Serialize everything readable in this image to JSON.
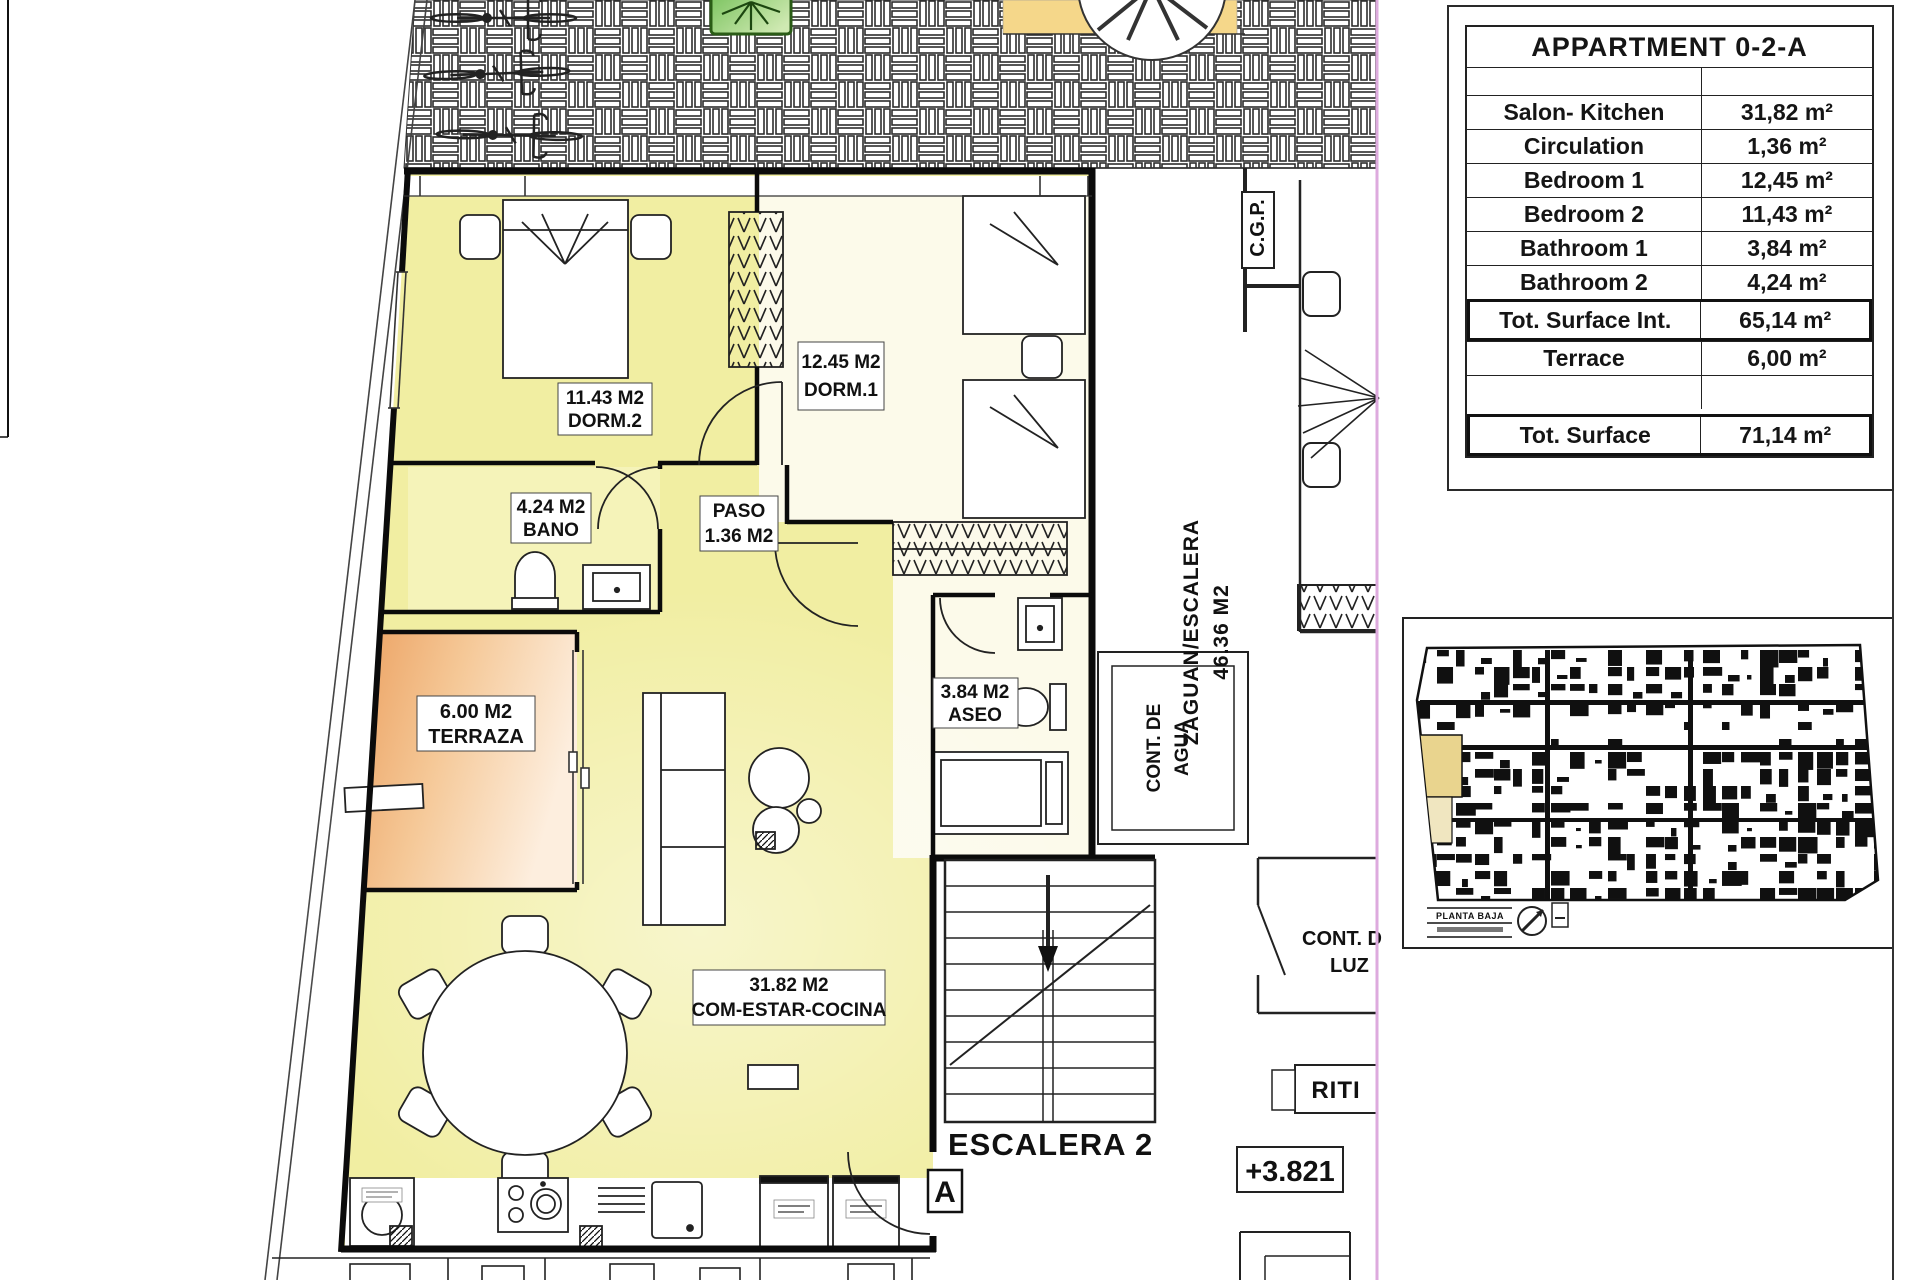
{
  "table": {
    "title": "APPARTMENT 0-2-A",
    "rows": [
      {
        "label": "",
        "value": ""
      },
      {
        "label": "Salon- Kitchen",
        "value": "31,82 m²"
      },
      {
        "label": "Circulation",
        "value": "1,36 m²"
      },
      {
        "label": "Bedroom 1",
        "value": "12,45 m²"
      },
      {
        "label": "Bedroom 2",
        "value": "11,43 m²"
      },
      {
        "label": "Bathroom 1",
        "value": "3,84 m²"
      },
      {
        "label": "Bathroom 2",
        "value": "4,24 m²"
      },
      {
        "label": "Tot. Surface Int.",
        "value": "65,14 m²"
      },
      {
        "label": "Terrace",
        "value": "6,00 m²"
      },
      {
        "label": "",
        "value": ""
      },
      {
        "label": "Tot. Surface",
        "value": "71,14 m²"
      }
    ]
  },
  "plan": {
    "rooms": {
      "dorm2": {
        "area": "11.43 M2",
        "name": "DORM.2"
      },
      "dorm1": {
        "area": "12.45 M2",
        "name": "DORM.1"
      },
      "bano": {
        "area": "4.24 M2",
        "name": "BANO"
      },
      "paso": {
        "name": "PASO",
        "area": "1.36 M2"
      },
      "terraza": {
        "area": "6.00 M2",
        "name": "TERRAZA"
      },
      "aseo": {
        "area": "3.84 M2",
        "name": "ASEO"
      },
      "salon": {
        "area": "31.82 M2",
        "name": "COM-ESTAR-COCINA"
      }
    },
    "annotations": {
      "zaguan_line1": "ZAGUAN/ESCALERA",
      "zaguan_line2": "46.36 M2",
      "cgp": "C.G.P.",
      "cont_agua_line1": "CONT. DE",
      "cont_agua_line2": "AGUA",
      "cont_luz_line1": "CONT. D",
      "cont_luz_line2": "LUZ",
      "riti": "RITI",
      "escalera": "ESCALERA 2",
      "level": "+3.821",
      "entrance": "A"
    },
    "key_plan": {
      "caption": "PLANTA BAJA"
    }
  },
  "colors": {
    "room_yellow": "#f1eea2",
    "room_cream": "#fcfaea",
    "bano_yellow": "#f5f3b9",
    "terrace_start": "#eca364",
    "terrace_mid": "#f5c897",
    "terrace_end": "#fdeede",
    "canopy": "#f5d78a",
    "tree": "#57b33c",
    "tree_light": "#cfe9b2",
    "highlight_pink": "#ddaade",
    "wall": "#0b0b0b",
    "key_highlight": "#e9d48e"
  }
}
